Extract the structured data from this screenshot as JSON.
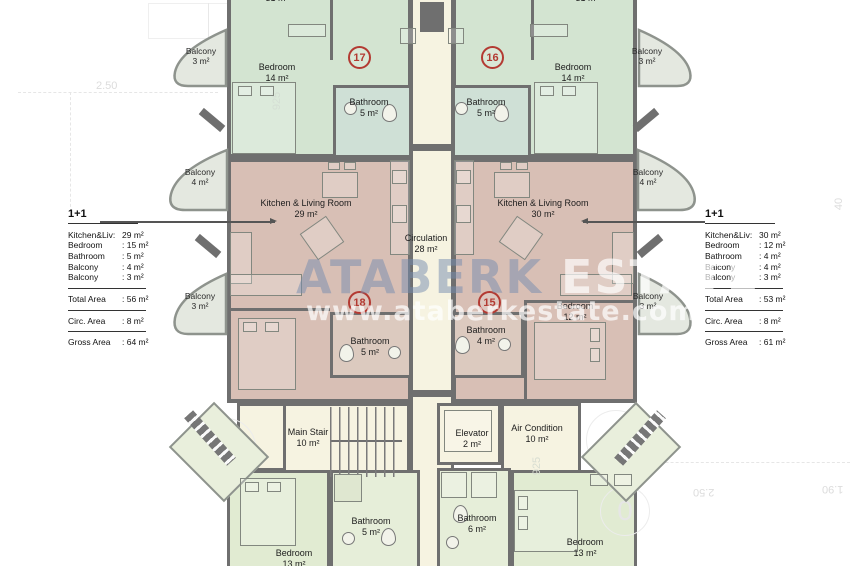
{
  "watermark": {
    "brand_a": "ATABERK",
    "brand_b": "ESTATE",
    "url": "www.ataberkestate.com"
  },
  "left_summary": {
    "title": "1+1",
    "items": [
      {
        "label": "Kitchen&Liv:",
        "value": "29 m²"
      },
      {
        "label": "Bedroom",
        "value": ": 15 m²"
      },
      {
        "label": "Bathroom",
        "value": ": 5  m²"
      },
      {
        "label": "Balcony",
        "value": ": 4  m²"
      },
      {
        "label": "Balcony",
        "value": ": 3  m²"
      }
    ],
    "total_label": "Total Area",
    "total_value": ": 56 m²",
    "circ_label": "Circ. Area",
    "circ_value": ": 8 m²",
    "gross_label": "Gross Area",
    "gross_value": ": 64 m²"
  },
  "right_summary": {
    "title": "1+1",
    "items": [
      {
        "label": "Kitchen&Liv:",
        "value": "30 m²"
      },
      {
        "label": "Bedroom",
        "value": ": 12 m²"
      },
      {
        "label": "Bathroom",
        "value": ": 4  m²"
      },
      {
        "label": "Balcony",
        "value": ": 4  m²"
      },
      {
        "label": "Balcony",
        "value": ": 3  m²"
      }
    ],
    "total_label": "Total Area",
    "total_value": ": 53 m²",
    "circ_label": "Circ. Area",
    "circ_value": ": 8 m²",
    "gross_label": "Gross Area",
    "gross_value": ": 61 m²"
  },
  "units": {
    "top_left": "17",
    "top_right": "16",
    "mid_left": "18",
    "mid_right": "15"
  },
  "rooms": {
    "partial_top_left": {
      "area": "31 m²"
    },
    "partial_top_right": {
      "area": "31 m²"
    },
    "bedroom_17": {
      "name": "Bedroom",
      "area": "14 m²"
    },
    "bathroom_17": {
      "name": "Bathroom",
      "area": "5 m²"
    },
    "bedroom_16": {
      "name": "Bedroom",
      "area": "14 m²"
    },
    "bathroom_16": {
      "name": "Bathroom",
      "area": "5 m²"
    },
    "kitchen_left": {
      "name": "Kitchen & Living Room",
      "area": "29 m²"
    },
    "kitchen_right": {
      "name": "Kitchen & Living Room",
      "area": "30 m²"
    },
    "circulation": {
      "name": "Circulation",
      "area": "28 m²"
    },
    "bathroom_18": {
      "name": "Bathroom",
      "area": "5 m²"
    },
    "bathroom_15": {
      "name": "Bathroom",
      "area": "4 m²"
    },
    "bedroom_15": {
      "name": "Bedroom",
      "area": "12 m²"
    },
    "main_stair": {
      "name": "Main Stair",
      "area": "10 m²"
    },
    "elevator": {
      "name": "Elevator",
      "area": "2 m²"
    },
    "air_condition": {
      "name": "Air Condition",
      "area": "10 m²"
    },
    "bathroom_bottom_left": {
      "name": "Bathroom",
      "area": "5 m²"
    },
    "bathroom_bottom_right": {
      "name": "Bathroom",
      "area": "6 m²"
    },
    "bedroom_bottom_left": {
      "name": "Bedroom",
      "area": "13 m²"
    },
    "bedroom_bottom_right": {
      "name": "Bedroom",
      "area": "13 m²"
    }
  },
  "balconies": {
    "left": [
      {
        "name": "Balcony",
        "area": "3 m²"
      },
      {
        "name": "Balcony",
        "area": "4 m²"
      },
      {
        "name": "Balcony",
        "area": "3 m²"
      }
    ],
    "right": [
      {
        "name": "Balcony",
        "area": "3 m²"
      },
      {
        "name": "Balcony",
        "area": "4 m²"
      },
      {
        "name": "Balcony",
        "area": "3 m²"
      }
    ]
  },
  "dims": {
    "top_left": "2.50",
    "bottom_right_a": "2.50",
    "bottom_right_b": "1.90",
    "vert_a": "925",
    "vert_b": "925",
    "right_edge": "40",
    "circle_a": "8",
    "circle_b": "6",
    "circle_c": "0"
  },
  "colors": {
    "green": "#d3e4d1",
    "pink": "#d8bfb5",
    "cream": "#f6f3e1",
    "light_green": "#e1ebd2",
    "wall": "#6f6f6f",
    "balcony_fill": "#e4e8e0",
    "accent_red": "#b33a32"
  }
}
